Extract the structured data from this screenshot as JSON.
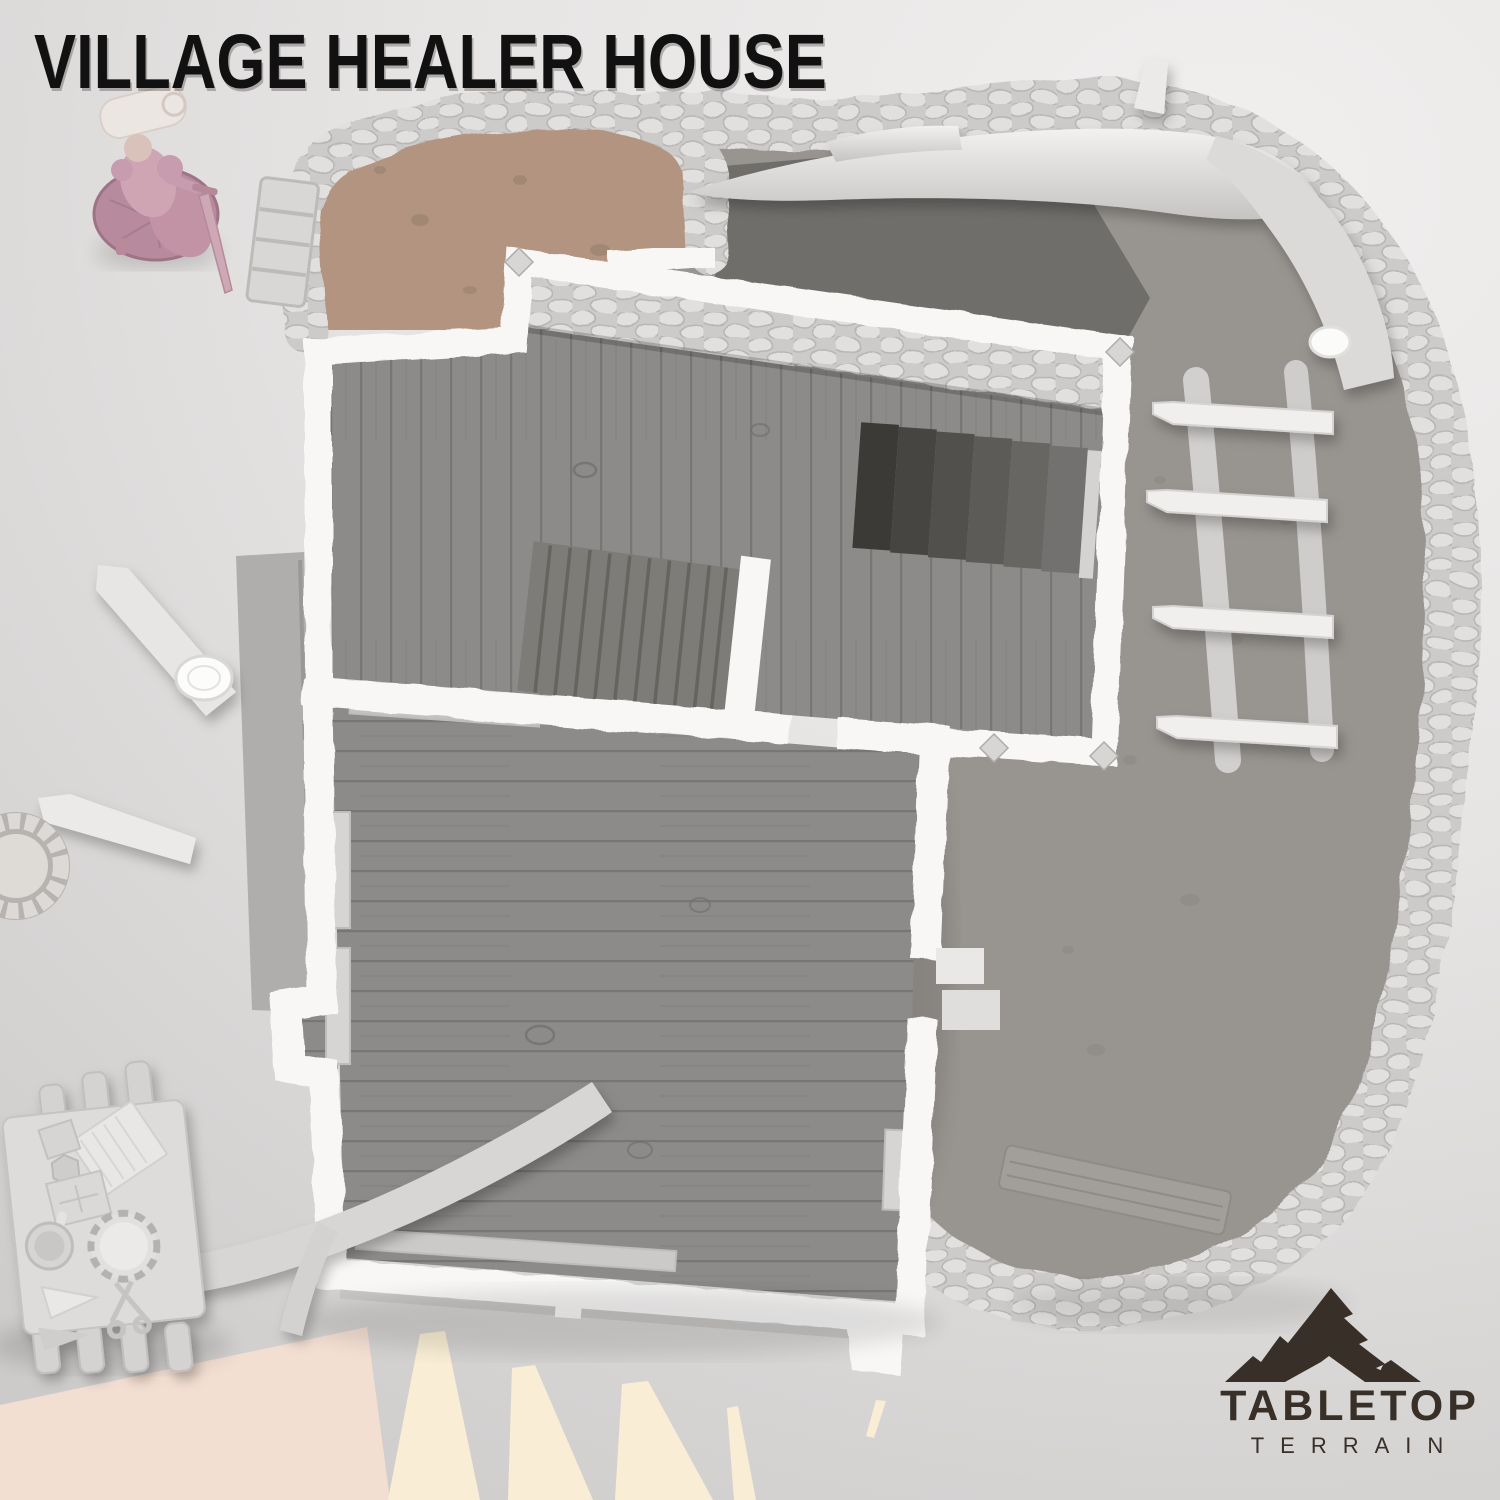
{
  "header": {
    "title": "VILLAGE HEALER HOUSE"
  },
  "branding": {
    "name_top": "TABLETOP",
    "name_bottom": "TERRAIN"
  },
  "palette": {
    "title_text": "#111111",
    "logo_color": "#382f28",
    "background_light": "#f1efee",
    "background_dark": "#c7c5c4",
    "wall_white": "#f8f7f6",
    "stone_base": "#cdcbc9",
    "wood_floor": "#8d8b89",
    "plank_line": "#787674",
    "stair_dark": "#45433f",
    "dirt_courtyard": "#b29480",
    "dirt_yard": "#989490",
    "ray_cream": "#f9eed5",
    "ray_pink": "#f3ded2",
    "mini_base": "#b78a9d",
    "mini_body": "#cfa5b4",
    "mini_white": "#ece6e2",
    "furniture_light": "#d7d5d3",
    "trunk_gray": "#b0aeac",
    "antler_light": "#f2f1f0",
    "antler_mid": "#c6c4c2"
  },
  "scene": {
    "objects": [
      "miniature-adventurer-figure",
      "dirt-courtyard",
      "upper-floor-room",
      "central-staircase",
      "cellar-stairwell",
      "main-room",
      "wall-benches",
      "walled-dirt-yard",
      "stone-perimeter-wall",
      "branch-ladder",
      "fallen-tree-branches",
      "root-over-table",
      "healer-work-table",
      "table-potions-and-books",
      "round-well",
      "light-rays"
    ]
  }
}
